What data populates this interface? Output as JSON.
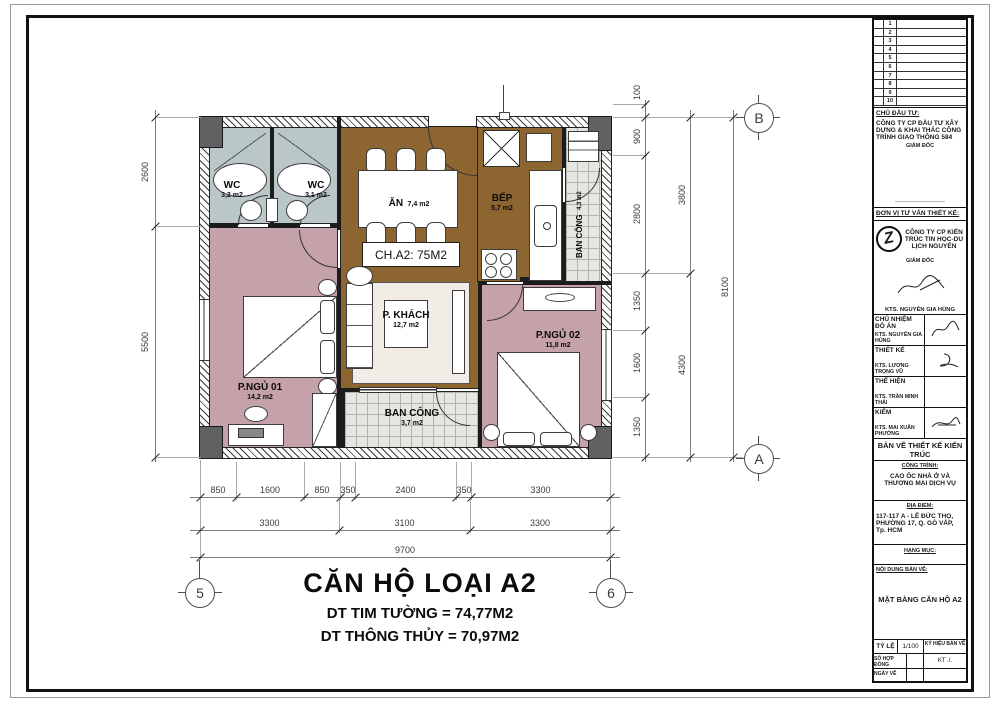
{
  "plan": {
    "unit_label": "CH.A2: 75M2",
    "rooms": [
      {
        "id": "wc1",
        "label": "WC",
        "area": "3,2 m2"
      },
      {
        "id": "wc2",
        "label": "WC",
        "area": "3,1 m2"
      },
      {
        "id": "dining",
        "label": "ĂN",
        "area": "7,4 m2"
      },
      {
        "id": "kitchen",
        "label": "BẾP",
        "area": "5,7 m2"
      },
      {
        "id": "balcony-right",
        "label": "BAN CÔNG",
        "area": "4,3 m2"
      },
      {
        "id": "living",
        "label": "P. KHÁCH",
        "area": "12,7 m2"
      },
      {
        "id": "bedroom1",
        "label": "P.NGỦ 01",
        "area": "14,2 m2"
      },
      {
        "id": "bedroom2",
        "label": "P.NGỦ 02",
        "area": "11,8 m2"
      },
      {
        "id": "balcony-bottom",
        "label": "BAN CÔNG",
        "area": "3,7 m2"
      }
    ],
    "colors": {
      "floor_brown": "#8c6531",
      "bedroom_pink": "#c5a1a9",
      "wc_blue": "#b9c7c9",
      "balcony_gray": "#e6e6e1",
      "column_gray": "#616161"
    }
  },
  "dims": {
    "left": [
      "2600",
      "5500"
    ],
    "right_inner": [
      "100",
      "900",
      "2800",
      "1350",
      "1600",
      "1350"
    ],
    "right_mid": [
      "3800",
      "4300"
    ],
    "right_outer": [
      "8100"
    ],
    "bottom1": [
      "850",
      "1600",
      "850",
      "350",
      "2400",
      "350",
      "3300"
    ],
    "bottom2": [
      "3300",
      "3100",
      "3300"
    ],
    "bottom3": [
      "9700"
    ]
  },
  "grid": {
    "bottom_left": "5",
    "bottom_right": "6",
    "top_right": "B",
    "right_bottom": "A"
  },
  "caption": {
    "title": "CĂN HỘ LOẠI A2",
    "line1": "DT TIM TƯỜNG = 74,77M2",
    "line2": "DT THÔNG THỦY = 70,97M2"
  },
  "title_block": {
    "revisions": [
      "1",
      "2",
      "3",
      "4",
      "5",
      "6",
      "7",
      "8",
      "9",
      "10"
    ],
    "investor_label": "CHỦ ĐẦU TƯ:",
    "investor_name": "CÔNG TY CP ĐẦU TƯ XÂY DỰNG & KHAI THÁC CÔNG TRÌNH GIAO THÔNG 584",
    "investor_role": "GIÁM ĐỐC",
    "dashes": "——————————",
    "consultant_label": "ĐƠN VỊ TƯ VẤN THIẾT KẾ:",
    "consultant_name": "CÔNG TY CP KIẾN TRÚC TIN HỌC-DU LỊCH NGUYÊN",
    "consultant_role": "GIÁM ĐỐC",
    "consultant_sign_name": "KTS. NGUYỄN GIA HÙNG",
    "logo_letter": "Z",
    "roles": [
      {
        "label": "CHỦ NHIỆM ĐỒ ÁN",
        "name": "KTS. NGUYỄN GIA HÙNG"
      },
      {
        "label": "THIẾT KẾ",
        "name": "KTS. LƯƠNG TRỌNG VŨ"
      },
      {
        "label": "THỂ HIỆN",
        "name": "KTS. TRẦN MINH THÁI"
      },
      {
        "label": "KIỂM",
        "name": "KTS. MAI XUÂN PHƯỞNG"
      }
    ],
    "drawing_type": "BẢN VẼ THIẾT KẾ KIẾN TRÚC",
    "project_label": "CÔNG TRÌNH:",
    "project_name": "CAO ỐC NHÀ Ở VÀ THƯƠNG MẠI DỊCH VỤ",
    "location_label": "ĐỊA ĐIỂM:",
    "location": "117-117 A - LÊ ĐỨC THỌ, PHƯỜNG 17, Q. GÒ VẤP, Tp. HCM",
    "category_label": "HẠNG MỤC:",
    "content_label": "NỘI DUNG BẢN VẼ:",
    "content": "MẶT BẰNG CĂN HỘ A2",
    "scale_label": "TỶ LỆ",
    "scale_value": "1/100",
    "drawing_no_label": "KÝ HIỆU BẢN VẼ",
    "contract_label": "SỐ HỢP ĐỒNG",
    "date_label": "NGÀY VẼ",
    "kt": "KT ./."
  }
}
